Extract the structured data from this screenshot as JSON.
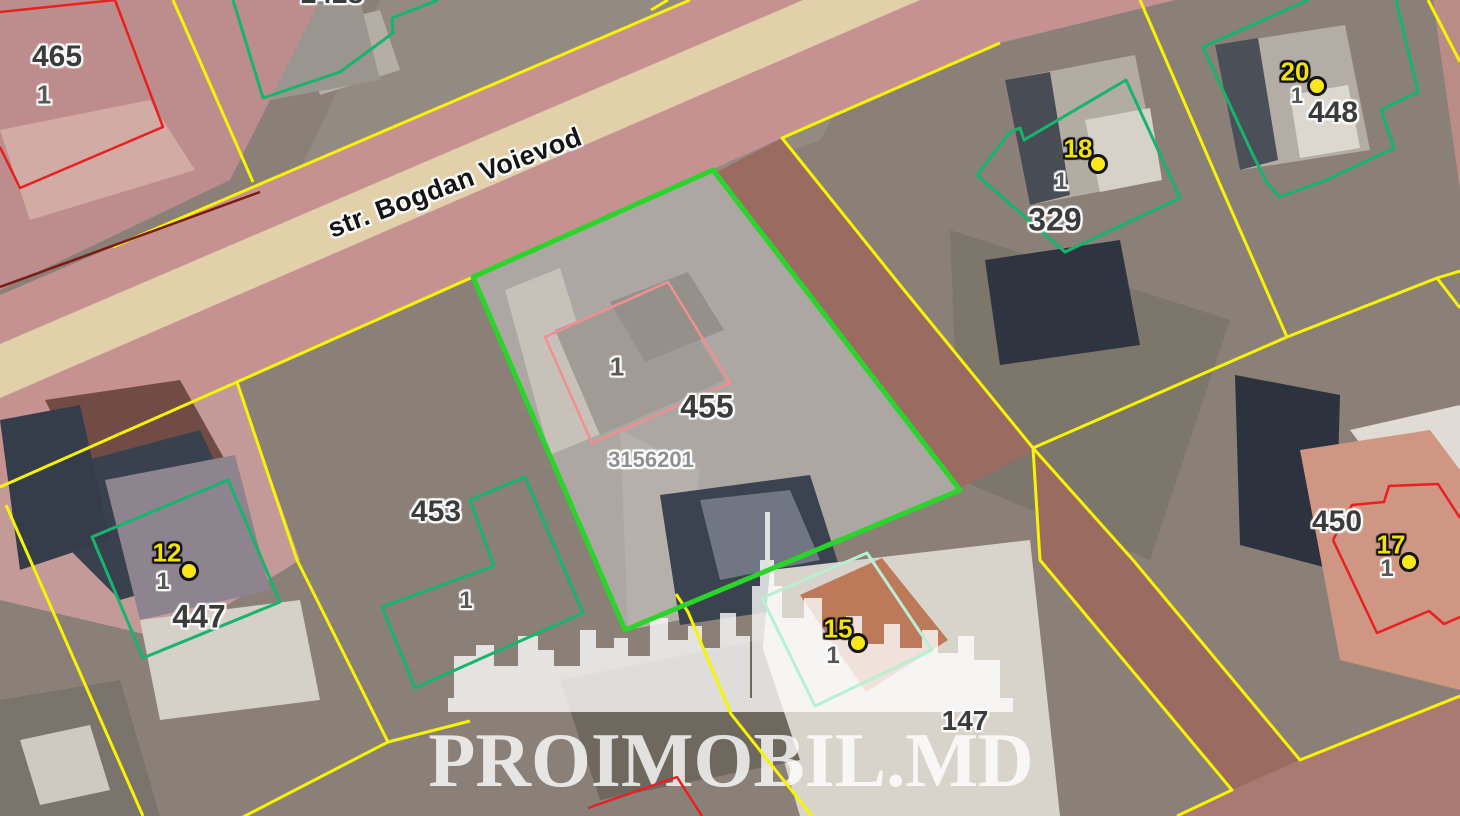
{
  "map": {
    "street": "str. Bogdan Voievod",
    "watermark": "PROIMOBIL.MD",
    "selected": {
      "number": "455",
      "building": "1",
      "cadastral_id": "3156201"
    },
    "parcels": [
      {
        "number": "465",
        "building": "1"
      },
      {
        "number": "2428"
      },
      {
        "number": "453",
        "building": "1"
      },
      {
        "number": "447",
        "building": "1",
        "pin": "12"
      },
      {
        "number": "329",
        "building": "1",
        "pin": "18"
      },
      {
        "number": "448",
        "building": "1",
        "pin": "20"
      },
      {
        "number": "450",
        "building": "1",
        "pin": "17"
      },
      {
        "number": "147",
        "building": "1",
        "pin": "15"
      }
    ],
    "colors": {
      "selected_boundary": "#2bd42b",
      "parcel_boundary_yellow": "#f7f400",
      "building_outline_green": "#17b46e",
      "building_outline_mint": "#b9efd4",
      "building_outline_red": "#e82020",
      "building_outline_salmon": "#f09090",
      "pin_fill": "#ffe81a",
      "pin_text": "#f2e300",
      "road_fill": "#c69191",
      "sidewalk_fill": "#e1d0aa"
    }
  }
}
